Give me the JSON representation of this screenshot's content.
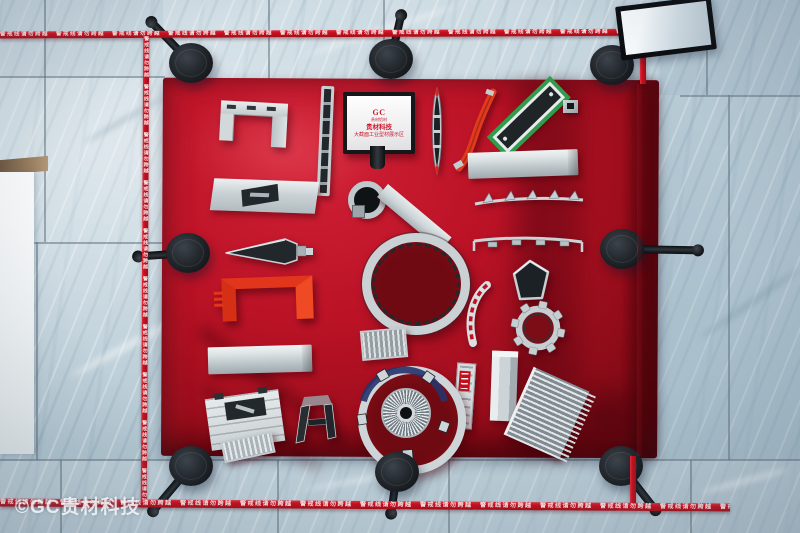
{
  "sign": {
    "logo": "GC",
    "logo_sub": "贵材铝材",
    "line1": "贵材科技",
    "line2": "大截面工业型材展示区"
  },
  "warning_tape": {
    "text": "警戒线请勿跨越",
    "strip": "警戒线请勿跨越　警戒线请勿跨越　警戒线请勿跨越　警戒线请勿跨越　警戒线请勿跨越　警戒线请勿跨越　警戒线请勿跨越　警戒线请勿跨越　警戒线请勿跨越　警戒线请勿跨越　警戒线请勿跨越　警戒线请勿跨越　警戒线请勿跨越　警戒线请勿跨越　警戒线请勿跨越　警戒线请勿跨越　警戒线请勿跨越　警戒线请勿跨越"
  },
  "watermark": {
    "text": "©GC贵材科技"
  },
  "scene": {
    "stanchion_count": 8,
    "tape_sides": 4
  },
  "colors": {
    "carpet_red": "#b01122",
    "tape_red": "#c8101e",
    "floor_blue_grey": "#bccfda",
    "stanchion_black": "#17191c",
    "aluminum_silver": "#ccd4d8",
    "profile_green": "#2f9e4a",
    "profile_orange_red": "#e2361c",
    "sign_text_red": "#cf1428",
    "dark_slot": "#23282c",
    "turbine_blue": "#26336b"
  },
  "objects": [
    "u-channel-profile",
    "slotted-strip-profile",
    "exhibit-sign",
    "canoe-profile",
    "red-blade-profile",
    "green-frame-profile",
    "connector-block",
    "slotted-plate-profile",
    "keyhole-tube-profile",
    "plank-profile",
    "box-beam-profile",
    "finned-rail-profile",
    "ring-profile",
    "tab-rail-profile",
    "wedge-profile",
    "red-channel-profile",
    "pentagon-profile",
    "arc-profile",
    "gear-profile",
    "ribbed-strip-profile",
    "bar-profile",
    "column-profile",
    "ruler-profile",
    "turbine-ring-profile",
    "heatsink-plate-profile",
    "heatsink-block-profile",
    "a-frame-profile",
    "ribbed-piece-profile"
  ]
}
